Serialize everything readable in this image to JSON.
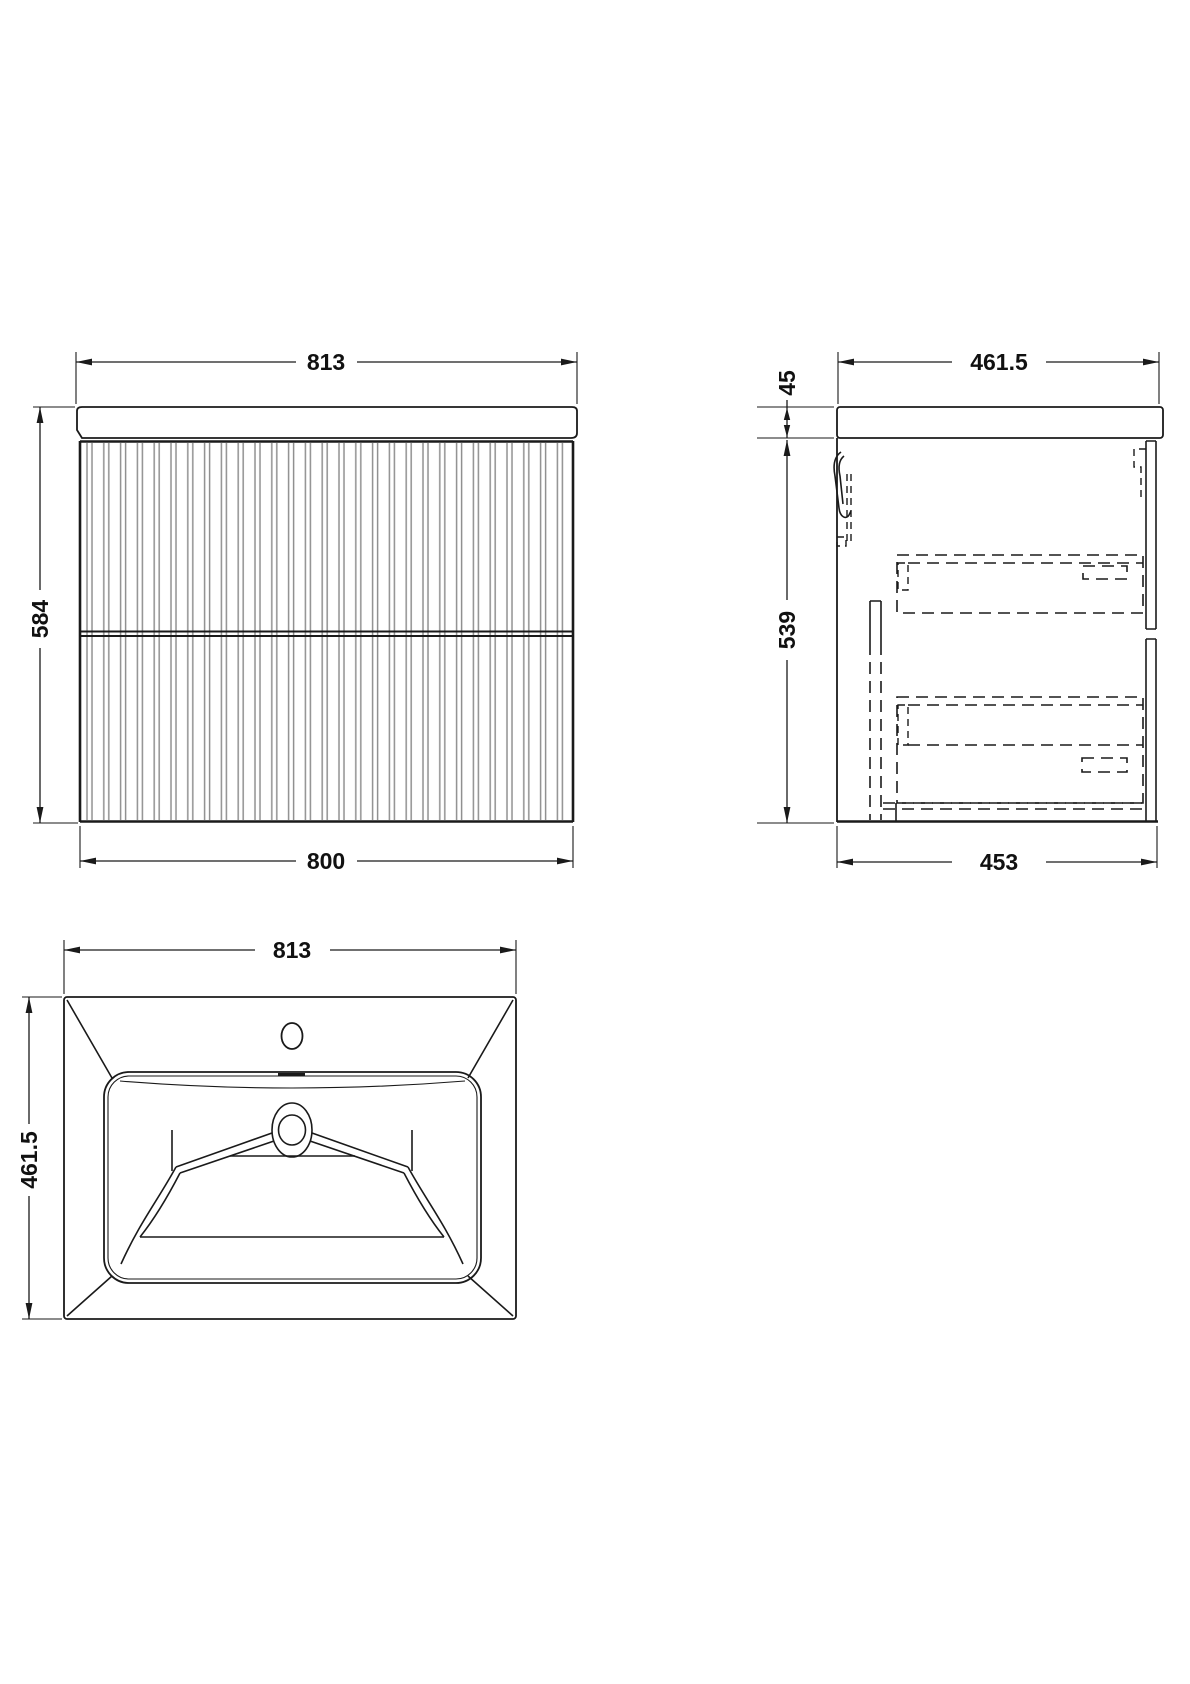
{
  "drawing": {
    "background_color": "#ffffff",
    "line_color": "#1a1a1a",
    "flute_color": "#909090",
    "views": {
      "front": {
        "dimensions": {
          "top_width": "813",
          "height": "584",
          "bottom_width": "800"
        }
      },
      "side": {
        "dimensions": {
          "top_depth": "461.5",
          "worktop_thickness": "45",
          "cabinet_height": "539",
          "bottom_depth": "453"
        }
      },
      "basin_plan": {
        "dimensions": {
          "width": "813",
          "depth": "461.5"
        }
      }
    }
  }
}
